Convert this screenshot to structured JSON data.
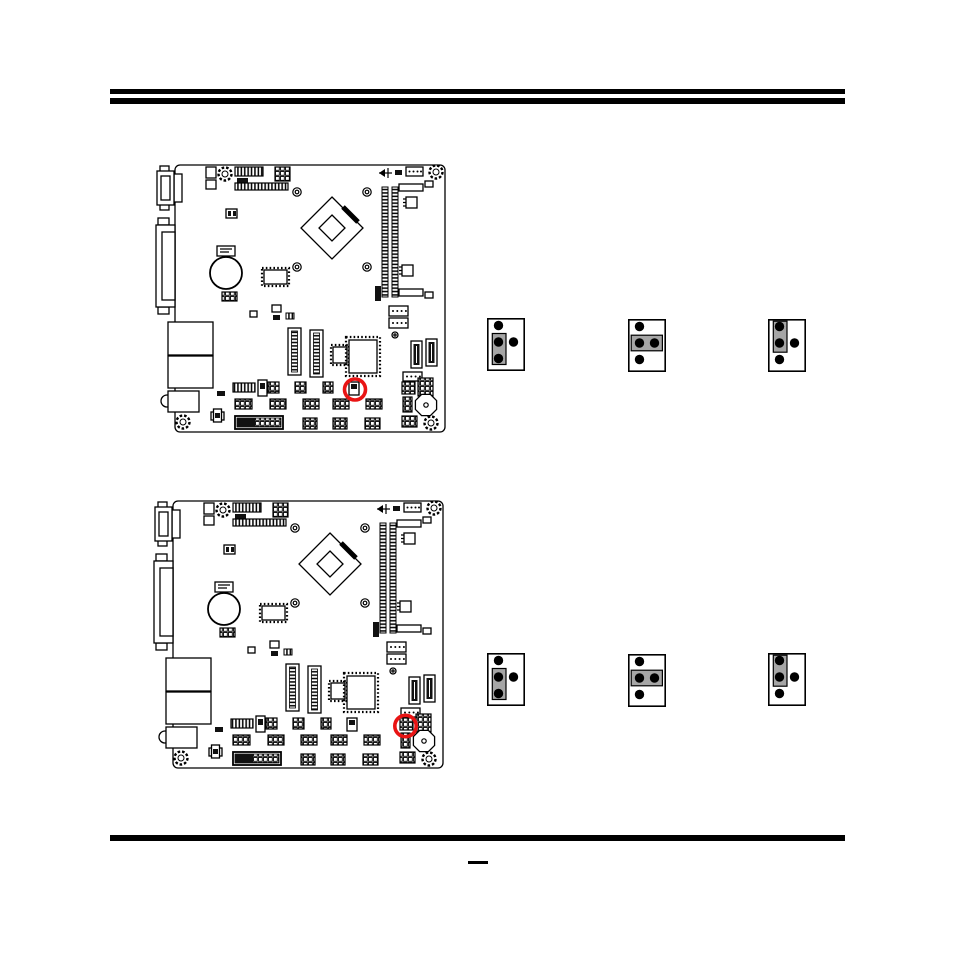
{
  "page": {
    "kind": "motherboard-jumper-settings-manual-page",
    "footer_mark": "—"
  },
  "colors": {
    "background": "#ffffff",
    "line": "#000000",
    "jumper_cap": "#a6a6a6",
    "highlight": "#e91414"
  },
  "boards": [
    {
      "label": "board-figure-1",
      "highlight": {
        "cx": 200,
        "cy": 228.5,
        "r": 10.5
      }
    },
    {
      "label": "board-figure-2",
      "highlight": {
        "cx": 252.5,
        "cy": 229,
        "r": 10.7
      }
    }
  ],
  "jumper_settings": [
    {
      "figure": "row-1",
      "diagrams": [
        {
          "pins": 4,
          "cap": "2-3"
        },
        {
          "pins": 4,
          "cap": "2-4"
        },
        {
          "pins": 4,
          "cap": "1-2"
        }
      ]
    },
    {
      "figure": "row-2",
      "diagrams": [
        {
          "pins": 4,
          "cap": "2-3"
        },
        {
          "pins": 4,
          "cap": "2-4"
        },
        {
          "pins": 4,
          "cap": "1-2"
        }
      ]
    }
  ]
}
